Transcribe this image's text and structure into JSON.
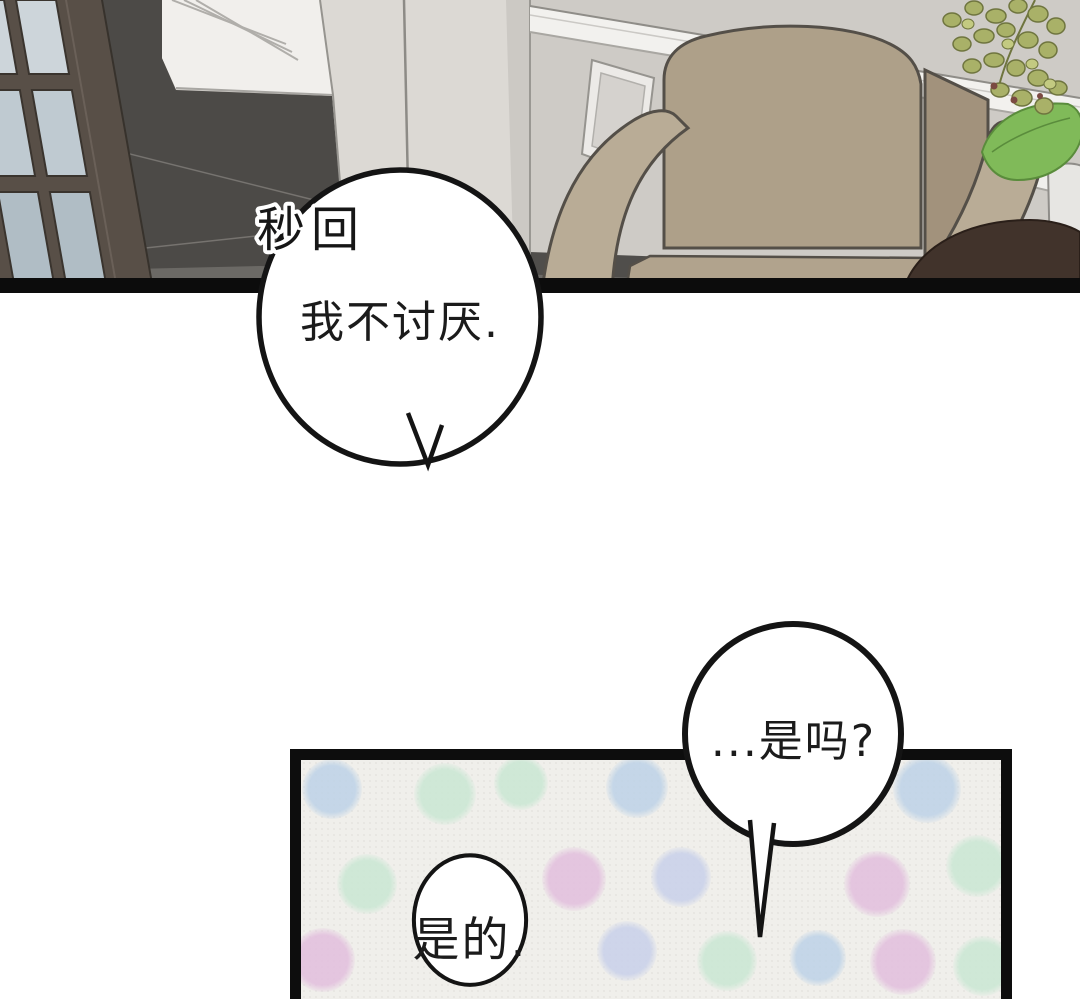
{
  "page": {
    "width": 1080,
    "height": 999,
    "background": "#ffffff"
  },
  "labels": {
    "instant_reply": "秒回"
  },
  "bubbles": [
    {
      "id": "bubble-1",
      "text": "我不讨厌."
    },
    {
      "id": "bubble-2",
      "text": "...是吗?"
    },
    {
      "id": "bubble-3",
      "text": "是的."
    }
  ],
  "palette": {
    "panel_border": "#0d0d0d",
    "bubble_stroke": "#141414",
    "bubble_fill": "#ffffff",
    "text_color": "#1b1b1b",
    "wall_gray": "#cecbc6",
    "pillar_gray": "#dcd9d4",
    "white_wall": "#f1efec",
    "floor_dark": "#4c4a47",
    "floor_light_wedge": "#6b6965",
    "door_frame_brown": "#584f47",
    "door_glass": "#c2ccd2",
    "chair_tan": "#aea089",
    "chair_arm_tan": "#b9ac96",
    "plant_green": "#a9b168",
    "leaf_green": "#80ba59",
    "pot_brown": "#41332b",
    "panel2_bg": "#f0efeb",
    "dot_blue": "#bdd2e7",
    "dot_mint": "#c9e7d3",
    "dot_pink": "#e2bedd",
    "dot_lavender": "#c8d0ea"
  },
  "polka_dots": {
    "panel_origin": {
      "x": 301,
      "y": 760
    },
    "dots": [
      {
        "x": 332,
        "y": 789,
        "r": 30,
        "c": "#bdd2e7"
      },
      {
        "x": 445,
        "y": 794,
        "r": 31,
        "c": "#c9e7d3"
      },
      {
        "x": 521,
        "y": 783,
        "r": 27,
        "c": "#c9e7d3"
      },
      {
        "x": 637,
        "y": 787,
        "r": 31,
        "c": "#bdd2e7"
      },
      {
        "x": 927,
        "y": 789,
        "r": 34,
        "c": "#bdd2e7"
      },
      {
        "x": 367,
        "y": 884,
        "r": 30,
        "c": "#c9e7d3"
      },
      {
        "x": 574,
        "y": 879,
        "r": 32,
        "c": "#e2bedd"
      },
      {
        "x": 681,
        "y": 877,
        "r": 30,
        "c": "#c8d0ea"
      },
      {
        "x": 877,
        "y": 884,
        "r": 33,
        "c": "#e2bedd"
      },
      {
        "x": 977,
        "y": 866,
        "r": 31,
        "c": "#c9e7d3"
      },
      {
        "x": 323,
        "y": 960,
        "r": 32,
        "c": "#e2bedd"
      },
      {
        "x": 627,
        "y": 951,
        "r": 30,
        "c": "#c8d0ea"
      },
      {
        "x": 727,
        "y": 961,
        "r": 30,
        "c": "#c9e7d3"
      },
      {
        "x": 818,
        "y": 958,
        "r": 28,
        "c": "#bdd2e7"
      },
      {
        "x": 903,
        "y": 962,
        "r": 33,
        "c": "#e2bedd"
      },
      {
        "x": 983,
        "y": 966,
        "r": 30,
        "c": "#c9e7d3"
      }
    ]
  }
}
